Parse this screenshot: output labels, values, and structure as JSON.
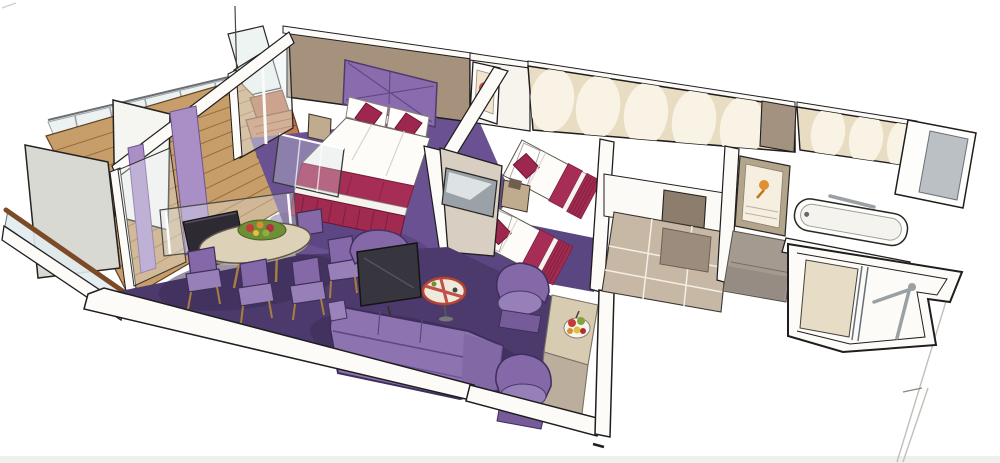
{
  "meta": {
    "type": "hand-drawn watercolor isometric cutaway floor plan",
    "subject": "cruise-ship suite illustration",
    "width_px": 1000,
    "height_px": 463,
    "background": "#ffffff"
  },
  "palette": {
    "outline": "#1f1d1e",
    "wall_white": "#fcfbf8",
    "wall_cream": "#f7f4ee",
    "wall_taupe": "#a5917c",
    "wall_taupe_dark": "#a3927f",
    "door_taupe": "#8d7d6d",
    "arch_wall": "#e8dcc2",
    "arch_cream": "#f8f3e4",
    "panel_gray": "#d9d9d3",
    "glass": "#e9f0f0",
    "curtain_purple": "#a98fc6",
    "deck_wood": "#c79d69",
    "deck_line": "#9a6c3c",
    "rail_wood": "#7b4a26",
    "carpet_bedroom": "#6a5292",
    "carpet_living": "#4c3a6d",
    "carpet_bedroom2": "#5a4680",
    "carpet_shadow": "#382a52",
    "headboard_purple": "#8a6cae",
    "bed_white": "#fdfcf8",
    "bed_magenta": "#a62d55",
    "bed_skirt": "#a12a50",
    "cushion_magenta": "#9e2750",
    "sofa_purple": "#8d74b0",
    "sofa_shadow": "#7c63a0",
    "chair_purple": "#8468a8",
    "chair_seat": "#977fb8",
    "table_wood": "#ddd2b8",
    "cabinet_dark": "#2e2a33",
    "tv_dark": "#37363e",
    "screen_silver": "#9aa2a8",
    "floor_tile": "#c6b8a4",
    "floor_gray": "#a49a90",
    "shower_floor": "#e7ddc6",
    "sideboard": "#d7cbb2",
    "sideboard_front": "#bcae9c",
    "nightstand_wood": "#c0ab8e",
    "metal": "#9aa0a4",
    "fruit_red": "#c53b3a",
    "fruit_green": "#86a23f",
    "fruit_yellow": "#e0c040",
    "accent_orange": "#e09030"
  },
  "scene": {
    "rooms": [
      {
        "id": "balcony",
        "label": "balcony",
        "items": [
          "glass balustrade",
          "privacy partitions",
          "teak deck",
          "sun lounger",
          "purple curtains"
        ]
      },
      {
        "id": "master-bedroom",
        "label": "master bedroom",
        "items": [
          "double bed",
          "quilted headboard",
          "accent cushions",
          "nightstand",
          "wall art",
          "glass footboard screen",
          "purple carpet"
        ]
      },
      {
        "id": "living-dining",
        "label": "living and dining room",
        "items": [
          "oval dining table",
          "floral centerpiece",
          "dining chairs",
          "dark writing desk",
          "glass partition",
          "sofa",
          "flat-screen tv",
          "round serving table",
          "tub chairs",
          "credenza with fruit bowl",
          "purple carpet"
        ]
      },
      {
        "id": "second-bedroom",
        "label": "second bedroom",
        "items": [
          "twin beds",
          "nightstand",
          "wall mounted tv",
          "arched feature wall"
        ]
      },
      {
        "id": "corridor",
        "label": "entrance corridor",
        "items": [
          "beige tiled floor",
          "entry door",
          "dark floor tile"
        ]
      },
      {
        "id": "bathroom",
        "label": "bathroom",
        "items": [
          "vanity mirror cabinet",
          "bathtub",
          "grab bar",
          "arched feature wall",
          "gray tiled floor"
        ]
      },
      {
        "id": "shower-room",
        "label": "shower room",
        "items": [
          "shower enclosure",
          "glass door",
          "grab bars"
        ]
      }
    ]
  }
}
